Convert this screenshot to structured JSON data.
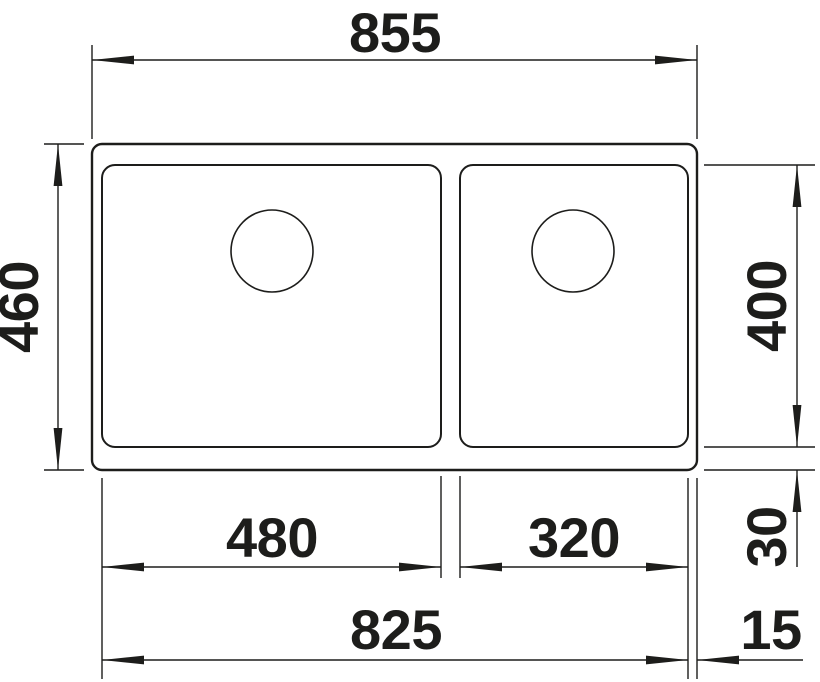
{
  "colors": {
    "line": "#1d1d1b",
    "background": "#ffffff"
  },
  "drawing": {
    "type": "technical-dimension-drawing",
    "dimensions": {
      "overall_width": "855",
      "overall_depth": "460",
      "bowl_depth": "400",
      "left_bowl_width": "480",
      "right_bowl_width": "320",
      "bowls_total_width": "825",
      "bottom_offset": "30",
      "right_offset": "15"
    }
  }
}
